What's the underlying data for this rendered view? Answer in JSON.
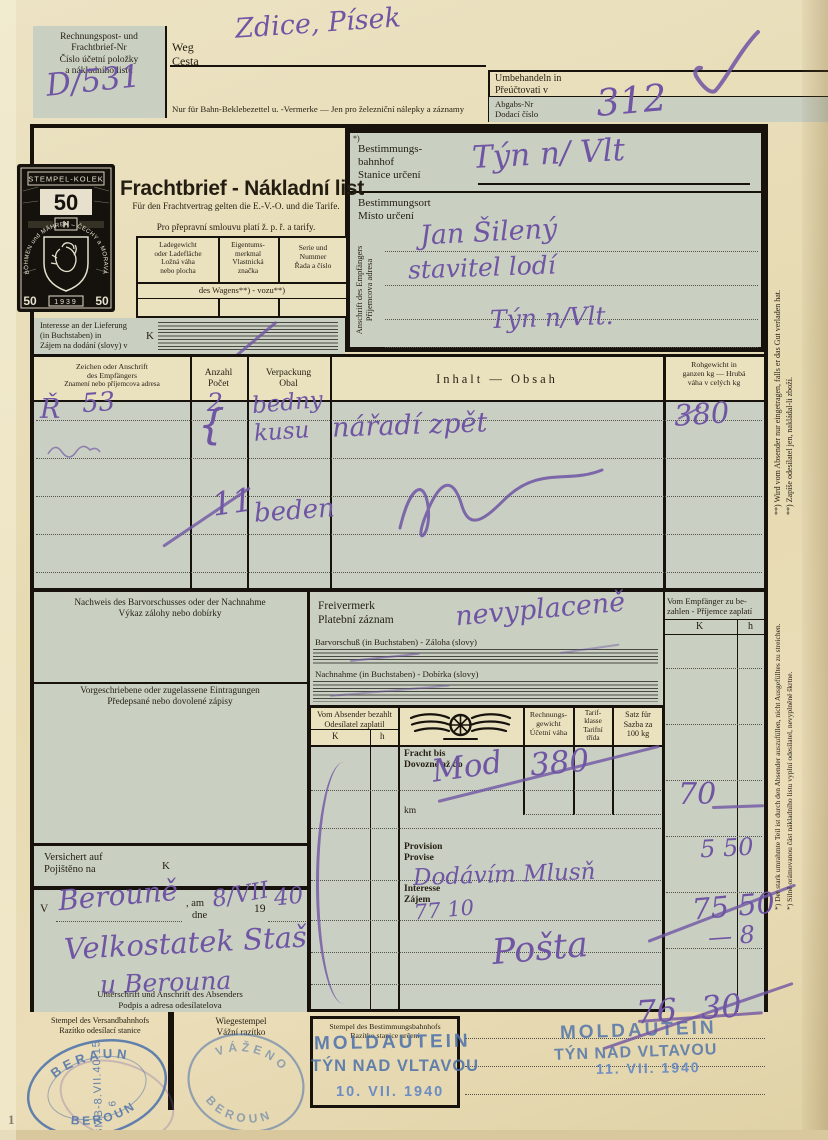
{
  "page": {
    "number": "1"
  },
  "colors": {
    "ink": "#6f55a4",
    "stamp_blue": "#4a70ab",
    "paper": "#e8ddb6",
    "panel": "#c9cfc1"
  },
  "top": {
    "billnr_de1": "Rechnungspost- und",
    "billnr_de2": "Frachtbrief-Nr",
    "billnr_cs1": "Číslo účetní položky",
    "billnr_cs2": "a nákladního listu",
    "billnr_value": "D/531",
    "weg_de": "Weg",
    "weg_cs": "Cesta",
    "route_value": "Zdice, Písek",
    "bahn_note": "Nur für Bahn-Beklebezettel u. -Vermerke — Jen pro železniční nálepky a záznamy",
    "umb_de": "Umbehandeln in",
    "umb_cs": "Přeúčtovati v",
    "abgabs_de": "Abgabs-Nr",
    "abgabs_cs": "Dodací číslo",
    "abgabs_value": "312"
  },
  "stamp": {
    "header": "STEMPEL-KOLEK",
    "value": "50",
    "currency": "H",
    "arc": "BÖHMEN und MÄHREN – ČECHY a MORAVA",
    "year": "1939",
    "corner_left": "50",
    "corner_right": "50"
  },
  "title": {
    "main": "Frachtbrief - Nákladní list",
    "sub_de": "Für den Frachtvertrag gelten die E.-V.-O. und die Tarife.",
    "sub_cs": "Pro přepravní smlouvu platí ž. p. ř. a tarify."
  },
  "wagon": {
    "c1a": "Ladegewicht",
    "c1b": "oder Ladefläche",
    "c1c": "Ložná váha",
    "c1d": "nebo plocha",
    "c2a": "Eigentums-",
    "c2b": "merkmal",
    "c2c": "Vlastnická",
    "c2d": "značka",
    "c3a": "Serie und",
    "c3b": "Nummer",
    "c3c": "Řada a číslo",
    "row": "des Wagens**) - vozu**)"
  },
  "interesse": {
    "de1": "Interesse an der Lieferung",
    "de2": "(in Buchstaben) in",
    "cs": "Zájem na dodání (slovy) v",
    "k": "K"
  },
  "dest": {
    "star": "*)",
    "de1": "Bestimmungs-",
    "de2": "bahnhof",
    "cs": "Stanice určení",
    "station": "Týn n/ Vlt",
    "ort_de": "Bestimmungsort",
    "ort_cs": "Místo určení",
    "empf_de": "Anschrift des Empfängers",
    "empf_cs": "Příjemcova adresa",
    "addr1": "Jan Šilený",
    "addr2": "stavitel lodí",
    "addr3": "Týn n/Vlt."
  },
  "goods": {
    "h_z1": "Zeichen oder Anschrift",
    "h_z2": "des Empfängers",
    "h_z3": "Znamení nebo příjemcova adresa",
    "h_a1": "Anzahl",
    "h_a2": "Počet",
    "h_v1": "Verpackung",
    "h_v2": "Obal",
    "h_i": "Inhalt — Obsah",
    "h_r1": "Rohgewicht in",
    "h_r2": "ganzen kg — Hrubá",
    "h_r3": "váha v celých kg",
    "mark": "Ř",
    "mark_no": "53",
    "qty1": "2",
    "brace": "{",
    "pack1": "bedny",
    "pack1b": "kusu",
    "content": "nářadí zpět",
    "weight": "380",
    "qty2": "11",
    "pack2": "beden"
  },
  "boxes": {
    "nachweis_de": "Nachweis des Barvorschusses oder der Nachnahme",
    "nachweis_cs": "Výkaz zálohy nebo dobírky",
    "vorg_de": "Vorgeschriebene oder zugelassene Eintragungen",
    "vorg_cs": "Předepsané nebo dovolené zápisy",
    "vers_de": "Versichert auf",
    "vers_cs": "Pojištěno na",
    "vers_k": "K"
  },
  "dateline": {
    "v": "V",
    "am": ", am",
    "dne": "dne",
    "y19": "19",
    "place": "Berouně",
    "day": "8/VII",
    "yy": "40"
  },
  "signature": {
    "line1": "Velkostatek Stašov",
    "line2": "u Berouna",
    "label_de": "Unterschrift und Anschrift des Absenders",
    "label_cs": "Podpis a adresa odesílatelova"
  },
  "frei": {
    "de": "Freivermerk",
    "cs": "Platební záznam",
    "value": "nevyplaceně",
    "bar": "Barvorschuß (in Buchstaben) - Záloha (slovy)",
    "nach": "Nachnahme (in Buchstaben) - Dobírka (slovy)"
  },
  "empf": {
    "l1": "Vom Empfänger zu be-",
    "l2": "zahlen - Příjemce zaplatí",
    "k": "K",
    "h": "h",
    "a1": "70",
    "a2": "5 50",
    "a3": "75 50",
    "a4": "— 8"
  },
  "pay": {
    "abs1": "Vom Absender bezahlt",
    "abs2": "Odesílatel zaplatil",
    "k": "K",
    "h": "h",
    "rg1": "Rechnungs-",
    "rg2": "gewicht",
    "rg3": "Účetní váha",
    "tk1": "Tarif-",
    "tk2": "klasse",
    "tk3": "Tarifní",
    "tk4": "třída",
    "s1": "Satz für",
    "s2": "Sazba za",
    "s3": "100 kg",
    "fracht1": "Fracht bis",
    "fracht2": "Dovozné až do",
    "km": "km",
    "prov1": "Provision",
    "prov2": "Provise",
    "int1": "Interesse",
    "int2": "Zájem",
    "hw_km": "Mod",
    "hw_weight": "380",
    "hw_note": "Dodávím Mlusň",
    "hw_sum": "77 10",
    "hw_posta": "Pošta"
  },
  "stampsrow": {
    "versand_de": "Stempel des Versandbahnhofs",
    "versand_cs": "Razítko odesílací stanice",
    "wiege_de": "Wiegestempel",
    "wiege_cs": "Vážní razítko",
    "best_de": "Stempel des Bestimmungsbahnhofs",
    "best_cs": "Razítko stanice určení"
  },
  "rubber": {
    "beraun_top": "BERAUN",
    "beraun_bottom": "BEROUN",
    "beraun_center": "BMB-8.VII.40.15",
    "beraun_num": "6",
    "wiege_top": "VÁŽENO",
    "wiege_bottom": "BEROUN",
    "mold_l1": "MOLDAUTEIN",
    "mold_l2": "TÝN NAD VLTAVOU",
    "mold1_date": "10. VII. 1940",
    "mold2_date": "11. VII. 1940",
    "hw_total": "76 30"
  },
  "margin": {
    "n1de": "**) Wird vom Absender nur eingetragen, falls er das Gut verladen hat.",
    "n1cs": "**) Zapíše odesílatel jen, nakládal-li zboží.",
    "n2de": "*) Der stark umrahmte Teil ist durch den Absender auszufüllen, nicht Ausgefülltes zu streichen.",
    "n2cs": "*) Silně orámovanou část nákladního listu vyplní odesílatel, nevyplněné škrtne."
  }
}
